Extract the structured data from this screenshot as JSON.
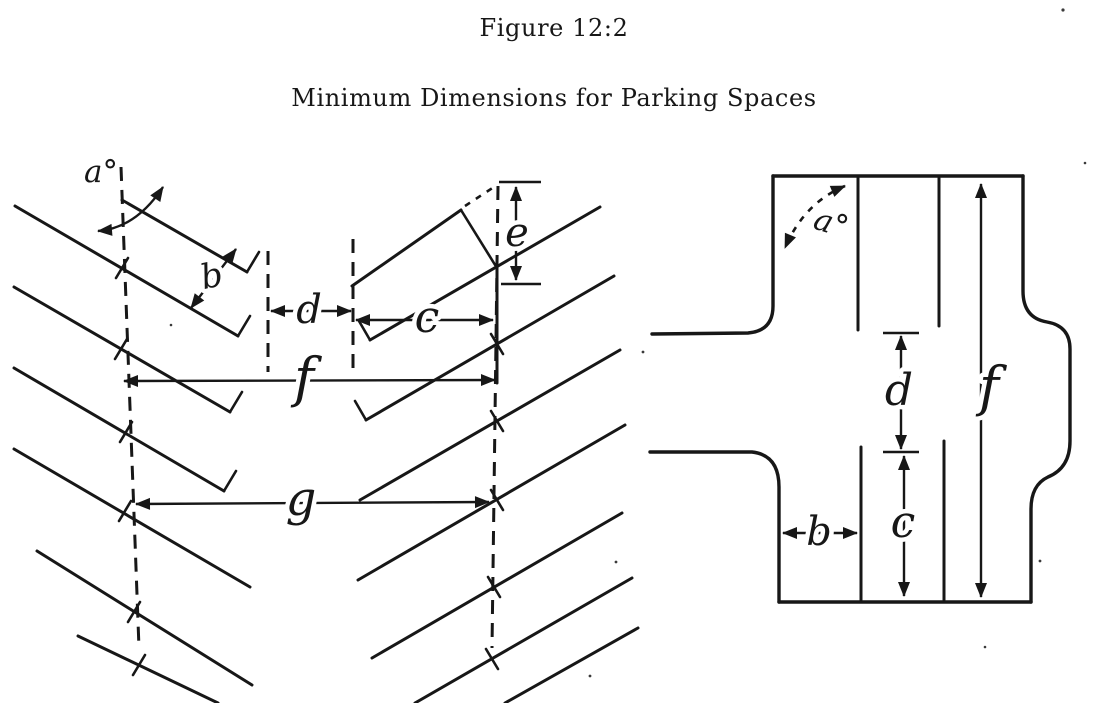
{
  "figure": {
    "title": "Figure 12:2",
    "subtitle": "Minimum Dimensions for Parking Spaces"
  },
  "angled_parking_diagram": {
    "labels": {
      "a": "a°",
      "b": "b",
      "c": "c",
      "d": "d",
      "e": "e",
      "f": "f",
      "g": "g"
    }
  },
  "street_parking_diagram": {
    "labels": {
      "a": "a°",
      "b": "b",
      "c": "c",
      "d": "d",
      "f": "f"
    }
  },
  "ink_color": "#171717",
  "paper_color": "#ffffff"
}
